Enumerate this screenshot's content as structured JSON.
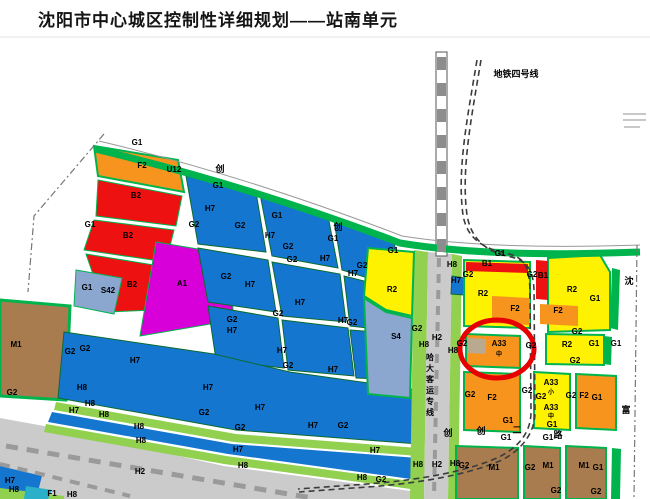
{
  "title": "沈阳市中心城区控制性详细规划——站南单元",
  "map": {
    "colors": {
      "blue": "#1576d0",
      "green": "#00b44d",
      "lgreen": "#92d050",
      "orange": "#f7941e",
      "red": "#ee1111",
      "yellow": "#fff200",
      "magenta": "#d800d8",
      "slate": "#8ba6cf",
      "brown": "#a87c4f",
      "gray": "#cbcbcb",
      "track": "#9a9a9a",
      "tan": "#b9a98e",
      "cyan": "#2ab0c8",
      "circle_red": "#e60000"
    },
    "annotations": {
      "metro_line_label": "地铁四号线",
      "railway_label_vertical": "哈大客运专线",
      "highlight_circle_target": "A33",
      "right_road_chars": "沈 富",
      "bottom_road_chars": "创 创 二 路"
    },
    "shapes": [
      {
        "n": "yard-h2",
        "f": "gray",
        "p": "0,418 44,426 224,466 418,492 418,499 0,499"
      },
      {
        "n": "parcel-f2-u12",
        "f": "orange",
        "st": "green",
        "sw": 2,
        "p": "94,146 178,160 184,192 98,176"
      },
      {
        "n": "parcel-b2-1",
        "f": "red",
        "st": "green",
        "sw": 1,
        "p": "98,180 182,196 176,226 96,216"
      },
      {
        "n": "parcel-b2-2",
        "f": "red",
        "st": "green",
        "sw": 1,
        "p": "94,220 174,230 166,262 84,250"
      },
      {
        "n": "parcel-b2-3",
        "f": "red",
        "st": "green",
        "sw": 1,
        "p": "86,254 160,266 154,310 106,312"
      },
      {
        "n": "parcel-s42",
        "f": "slate",
        "st": "green",
        "sw": 1,
        "p": "76,270 122,278 114,314 74,306"
      },
      {
        "n": "parcel-a1",
        "f": "magenta",
        "st": "green",
        "sw": 1,
        "p": "156,242 228,254 234,320 140,336"
      },
      {
        "n": "parcel-m1-west",
        "f": "brown",
        "st": "green",
        "sw": 3,
        "p": "0,300 70,306 66,400 0,396"
      },
      {
        "n": "parcel-h7",
        "f": "blue",
        "st": "#0a6b30",
        "sw": 1,
        "p": "186,176 256,192 266,252 198,244"
      },
      {
        "n": "parcel-h7",
        "f": "blue",
        "st": "#0a6b30",
        "sw": 1,
        "p": "260,194 328,216 338,268 272,256"
      },
      {
        "n": "parcel-h7",
        "f": "blue",
        "st": "#0a6b30",
        "sw": 1,
        "p": "334,220 394,240 400,288 342,270"
      },
      {
        "n": "parcel-h7",
        "f": "blue",
        "st": "#0a6b30",
        "sw": 1,
        "p": "198,248 268,260 276,312 208,302"
      },
      {
        "n": "parcel-h7",
        "f": "blue",
        "st": "#0a6b30",
        "sw": 1,
        "p": "272,262 340,274 346,322 282,316"
      },
      {
        "n": "parcel-h7",
        "f": "blue",
        "st": "#0a6b30",
        "sw": 1,
        "p": "344,276 400,290 404,332 350,326"
      },
      {
        "n": "parcel-h7",
        "f": "blue",
        "st": "#0a6b30",
        "sw": 1,
        "p": "208,306 278,318 284,368 216,360"
      },
      {
        "n": "parcel-h7",
        "f": "blue",
        "st": "#0a6b30",
        "sw": 1,
        "p": "282,320 348,328 354,376 288,370"
      },
      {
        "n": "parcel-h7",
        "f": "blue",
        "st": "#0a6b30",
        "sw": 1,
        "p": "350,330 404,334 408,380 356,378"
      },
      {
        "n": "parcel-h7-lower",
        "f": "blue",
        "st": "#0a6b30",
        "sw": 1,
        "p": "64,332 214,354 290,372 418,390 418,444 236,430 58,398"
      },
      {
        "n": "strip-h8",
        "f": "lgreen",
        "p": "56,402 236,434 418,448 418,456 234,442 54,410"
      },
      {
        "n": "strip-h7",
        "f": "blue",
        "p": "52,412 232,444 418,458 418,480 228,454 48,422"
      },
      {
        "n": "strip-h8",
        "f": "lgreen",
        "p": "46,424 226,456 418,482 418,490 224,464 44,432"
      },
      {
        "n": "corner-h7",
        "f": "blue",
        "p": "0,466 42,476 36,499 0,499"
      },
      {
        "n": "corner-h8",
        "f": "lgreen",
        "p": "0,488 64,496 64,499 0,499"
      },
      {
        "n": "corner-s",
        "f": "cyan",
        "p": "26,486 52,490 48,499 24,499"
      },
      {
        "n": "rail-strip-west",
        "f": "lgreen",
        "p": "414,250 428,252 424,499 410,499"
      },
      {
        "n": "rail-corridor-h2",
        "f": "gray",
        "p": "428,252 452,254 448,499 424,499"
      },
      {
        "n": "rail-strip-east",
        "f": "lgreen",
        "p": "452,254 462,256 458,499 448,499"
      },
      {
        "n": "parcel-h7-east-small",
        "f": "blue",
        "st": "#0a6b30",
        "sw": 1,
        "p": "452,276 465,278 464,295 451,294"
      },
      {
        "n": "parcel-r2-west",
        "f": "yellow",
        "st": "green",
        "sw": 2,
        "p": "368,248 414,252 412,316 386,310 364,296"
      },
      {
        "n": "parcel-s4",
        "f": "slate",
        "st": "green",
        "sw": 2,
        "p": "364,298 386,312 412,318 410,398 368,394"
      },
      {
        "n": "parcel-r2-a",
        "f": "yellow",
        "st": "green",
        "sw": 2,
        "p": "464,260 530,262 530,328 464,326"
      },
      {
        "n": "parcel-b1-strip",
        "f": "red",
        "p": "466,262 528,264 528,273 466,271"
      },
      {
        "n": "parcel-f2-inset",
        "f": "orange",
        "p": "492,296 530,298 530,325 492,323"
      },
      {
        "n": "parcel-r2-b",
        "f": "yellow",
        "st": "green",
        "sw": 2,
        "p": "548,258 600,255 610,272 610,330 548,332"
      },
      {
        "n": "parcel-b1-vert",
        "f": "red",
        "p": "536,260 548,261 548,300 536,299"
      },
      {
        "n": "parcel-f2-inset",
        "f": "orange",
        "p": "540,304 578,306 578,326 540,324"
      },
      {
        "n": "strip-g1-right",
        "f": "green",
        "p": "612,268 620,270 618,330 610,328"
      },
      {
        "n": "parcel-a33-circled",
        "f": "orange",
        "st": "green",
        "sw": 2,
        "p": "466,334 520,336 520,368 466,366"
      },
      {
        "n": "a33-inner-square",
        "f": "tan",
        "p": "468,338 486,339 486,354 468,353"
      },
      {
        "n": "parcel-r2-c",
        "f": "yellow",
        "st": "green",
        "sw": 2,
        "p": "546,334 604,335 604,365 546,364"
      },
      {
        "n": "strip-g1-right",
        "f": "green",
        "p": "604,336 612,337 611,365 603,364"
      },
      {
        "n": "parcel-f2-big",
        "f": "orange",
        "st": "green",
        "sw": 2,
        "p": "464,372 520,374 520,432 464,430"
      },
      {
        "n": "parcel-a33-block",
        "f": "yellow",
        "st": "green",
        "sw": 2,
        "p": "534,372 570,374 570,430 534,428"
      },
      {
        "n": "parcel-f2-east",
        "f": "orange",
        "st": "green",
        "sw": 2,
        "p": "576,374 616,376 616,430 576,428"
      },
      {
        "n": "parcel-m1-a",
        "f": "brown",
        "st": "green",
        "sw": 2,
        "p": "456,446 518,448 518,499 456,499"
      },
      {
        "n": "parcel-m1-b",
        "f": "brown",
        "st": "green",
        "sw": 2,
        "p": "524,446 560,448 560,499 524,499"
      },
      {
        "n": "parcel-m1-c",
        "f": "brown",
        "st": "green",
        "sw": 2,
        "p": "566,446 606,448 606,499 566,499"
      },
      {
        "n": "strip-g1-right",
        "f": "green",
        "p": "612,448 621,449 620,499 611,499"
      },
      {
        "n": "railway-bar",
        "f": "#ffffff",
        "st": "#555555",
        "sw": 1,
        "p": "436,52 447,52 447,256 436,256"
      }
    ],
    "lines": [
      {
        "n": "title-underline",
        "s": "#e5e5e5",
        "w": 1,
        "d": "M0,37 L650,37"
      },
      {
        "n": "boundary-arc-road",
        "s": "#999999",
        "w": 1,
        "d": "M99,141 Q250,177 402,236 Q490,250 640,245"
      },
      {
        "n": "greenbelt-arc",
        "s": "green",
        "w": 7,
        "d": "M95,149 Q250,186 400,243 Q490,258 640,252"
      },
      {
        "n": "boundary-left-dashed",
        "s": "#777777",
        "w": 1.2,
        "da": "7,3,2,3",
        "d": "M104,134 L34,216 L28,292"
      },
      {
        "n": "boundary-right-dashed",
        "s": "#777777",
        "w": 1.2,
        "da": "7,3,2,3",
        "d": "M637,245 L634,499"
      },
      {
        "n": "railway-bar-stripes",
        "s": "#8d8d8d",
        "w": 9,
        "da": "13,13",
        "d": "M441.5,57 L441.5,253"
      },
      {
        "n": "rail-track-corridor",
        "s": "track",
        "w": 4,
        "da": "9,7",
        "d": "M439,258 L434,497"
      },
      {
        "n": "rail-track-yard",
        "s": "track",
        "w": 5,
        "da": "12,9",
        "d": "M6,446 L312,498"
      },
      {
        "n": "rail-track-yard2",
        "s": "track",
        "w": 4,
        "da": "10,8",
        "d": "M0,464 L130,496"
      },
      {
        "n": "metro-line-4",
        "s": "#3c3c3c",
        "w": 1.6,
        "da": "6,4",
        "d": "M477,60 C467,120 457,170 463,215 C467,240 486,249 505,253 C526,257 529,268 530,290 L531,412 C531,432 519,447 499,457 C468,471 420,481 352,485 L298,489"
      },
      {
        "n": "metro-line-4",
        "s": "#3c3c3c",
        "w": 1.6,
        "da": "6,4",
        "d": "M481,60 C471,120 461,170 467,215 C471,240 488,252 507,256 C528,260 533,270 534,290 L535,412 C535,432 523,449 502,460 C470,474 421,484 353,488 L299,492"
      },
      {
        "n": "faint-stamp-line",
        "s": "#c8c8c8",
        "w": 2,
        "d": "M623,114 L646,114"
      },
      {
        "n": "faint-stamp-line",
        "s": "#c8c8c8",
        "w": 2,
        "d": "M623,120 L646,120"
      },
      {
        "n": "faint-stamp-line",
        "s": "#c8c8c8",
        "w": 2,
        "d": "M624,127 L640,127"
      },
      {
        "n": "highlight-circle",
        "s": "circle_red",
        "w": 5,
        "d": "M460,349 a37,29 0 1 0 74,0 a37,29 0 1 0 -74,0"
      }
    ],
    "labels": [
      {
        "t": "G1",
        "x": 137,
        "y": 145
      },
      {
        "t": "G1",
        "x": 218,
        "y": 188
      },
      {
        "t": "G1",
        "x": 277,
        "y": 218
      },
      {
        "t": "G1",
        "x": 333,
        "y": 241
      },
      {
        "t": "G1",
        "x": 393,
        "y": 253
      },
      {
        "t": "G1",
        "x": 500,
        "y": 256
      },
      {
        "t": "创",
        "x": 220,
        "y": 172,
        "s": 9
      },
      {
        "t": "创",
        "x": 338,
        "y": 230,
        "s": 9
      },
      {
        "t": "地铁四号线",
        "x": 516,
        "y": 77,
        "s": 9
      },
      {
        "t": "F2",
        "x": 142,
        "y": 168
      },
      {
        "t": "U12",
        "x": 174,
        "y": 172
      },
      {
        "t": "B2",
        "x": 136,
        "y": 198
      },
      {
        "t": "B2",
        "x": 128,
        "y": 238
      },
      {
        "t": "B2",
        "x": 132,
        "y": 287
      },
      {
        "t": "G1",
        "x": 90,
        "y": 227
      },
      {
        "t": "G1",
        "x": 87,
        "y": 290
      },
      {
        "t": "S42",
        "x": 108,
        "y": 293
      },
      {
        "t": "A1",
        "x": 182,
        "y": 286
      },
      {
        "t": "M1",
        "x": 16,
        "y": 347
      },
      {
        "t": "G2",
        "x": 70,
        "y": 354
      },
      {
        "t": "G2",
        "x": 85,
        "y": 351
      },
      {
        "t": "G2",
        "x": 12,
        "y": 395
      },
      {
        "t": "H7",
        "x": 210,
        "y": 211
      },
      {
        "t": "H7",
        "x": 270,
        "y": 238
      },
      {
        "t": "H7",
        "x": 325,
        "y": 261
      },
      {
        "t": "H7",
        "x": 353,
        "y": 276
      },
      {
        "t": "H7",
        "x": 250,
        "y": 287
      },
      {
        "t": "H7",
        "x": 300,
        "y": 305
      },
      {
        "t": "H7",
        "x": 343,
        "y": 323
      },
      {
        "t": "H7",
        "x": 232,
        "y": 333
      },
      {
        "t": "H7",
        "x": 282,
        "y": 353
      },
      {
        "t": "H7",
        "x": 333,
        "y": 372
      },
      {
        "t": "H7",
        "x": 135,
        "y": 363
      },
      {
        "t": "H7",
        "x": 208,
        "y": 390
      },
      {
        "t": "H7",
        "x": 260,
        "y": 410
      },
      {
        "t": "H7",
        "x": 313,
        "y": 428
      },
      {
        "t": "H7",
        "x": 238,
        "y": 452
      },
      {
        "t": "H7",
        "x": 375,
        "y": 453
      },
      {
        "t": "H7",
        "x": 74,
        "y": 413
      },
      {
        "t": "H7",
        "x": 10,
        "y": 483
      },
      {
        "t": "H7",
        "x": 456,
        "y": 283
      },
      {
        "t": "G2",
        "x": 194,
        "y": 227
      },
      {
        "t": "G2",
        "x": 240,
        "y": 228
      },
      {
        "t": "G2",
        "x": 288,
        "y": 249
      },
      {
        "t": "G2",
        "x": 292,
        "y": 262
      },
      {
        "t": "G2",
        "x": 226,
        "y": 279
      },
      {
        "t": "G2",
        "x": 232,
        "y": 322
      },
      {
        "t": "G2",
        "x": 278,
        "y": 316
      },
      {
        "t": "G2",
        "x": 352,
        "y": 325
      },
      {
        "t": "G2",
        "x": 288,
        "y": 368
      },
      {
        "t": "G2",
        "x": 240,
        "y": 430
      },
      {
        "t": "G2",
        "x": 343,
        "y": 428
      },
      {
        "t": "G2",
        "x": 204,
        "y": 415
      },
      {
        "t": "R2",
        "x": 392,
        "y": 292
      },
      {
        "t": "S4",
        "x": 396,
        "y": 339
      },
      {
        "t": "G2",
        "x": 362,
        "y": 268
      },
      {
        "t": "G2",
        "x": 417,
        "y": 331
      },
      {
        "t": "H8",
        "x": 452,
        "y": 267
      },
      {
        "t": "H8",
        "x": 424,
        "y": 347
      },
      {
        "t": "H2",
        "x": 437,
        "y": 340
      },
      {
        "t": "H8",
        "x": 453,
        "y": 353
      },
      {
        "t": "H8",
        "x": 418,
        "y": 467
      },
      {
        "t": "H2",
        "x": 437,
        "y": 467
      },
      {
        "t": "H8",
        "x": 455,
        "y": 466
      },
      {
        "t": "哈",
        "x": 430,
        "y": 360,
        "s": 8
      },
      {
        "t": "大",
        "x": 430,
        "y": 371,
        "s": 8
      },
      {
        "t": "客",
        "x": 430,
        "y": 382,
        "s": 8
      },
      {
        "t": "运",
        "x": 430,
        "y": 393,
        "s": 8
      },
      {
        "t": "专",
        "x": 430,
        "y": 404,
        "s": 8
      },
      {
        "t": "线",
        "x": 430,
        "y": 415,
        "s": 8
      },
      {
        "t": "B1",
        "x": 487,
        "y": 266
      },
      {
        "t": "B1",
        "x": 543,
        "y": 278
      },
      {
        "t": "G2",
        "x": 468,
        "y": 277
      },
      {
        "t": "G2",
        "x": 532,
        "y": 277
      },
      {
        "t": "R2",
        "x": 483,
        "y": 296
      },
      {
        "t": "F2",
        "x": 515,
        "y": 311
      },
      {
        "t": "R2",
        "x": 572,
        "y": 292
      },
      {
        "t": "F2",
        "x": 558,
        "y": 313
      },
      {
        "t": "G1",
        "x": 595,
        "y": 301
      },
      {
        "t": "沈",
        "x": 629,
        "y": 284,
        "s": 9
      },
      {
        "t": "G2",
        "x": 577,
        "y": 334
      },
      {
        "t": "A33",
        "x": 499,
        "y": 346
      },
      {
        "t": "中",
        "x": 499,
        "y": 356,
        "s": 6
      },
      {
        "t": "G2",
        "x": 462,
        "y": 346
      },
      {
        "t": "G2",
        "x": 531,
        "y": 348
      },
      {
        "t": "R2",
        "x": 567,
        "y": 347
      },
      {
        "t": "G1",
        "x": 594,
        "y": 346
      },
      {
        "t": "G1",
        "x": 616,
        "y": 346
      },
      {
        "t": "G2",
        "x": 575,
        "y": 363
      },
      {
        "t": "F2",
        "x": 492,
        "y": 400
      },
      {
        "t": "G2",
        "x": 470,
        "y": 397
      },
      {
        "t": "G1",
        "x": 508,
        "y": 423
      },
      {
        "t": "G2",
        "x": 527,
        "y": 393
      },
      {
        "t": "G2",
        "x": 541,
        "y": 399
      },
      {
        "t": "A33",
        "x": 551,
        "y": 385
      },
      {
        "t": "小",
        "x": 551,
        "y": 394,
        "s": 6
      },
      {
        "t": "A33",
        "x": 551,
        "y": 410
      },
      {
        "t": "中",
        "x": 551,
        "y": 418,
        "s": 6
      },
      {
        "t": "G1",
        "x": 552,
        "y": 427
      },
      {
        "t": "G2",
        "x": 571,
        "y": 398
      },
      {
        "t": "F2",
        "x": 584,
        "y": 398
      },
      {
        "t": "G1",
        "x": 597,
        "y": 400
      },
      {
        "t": "创",
        "x": 448,
        "y": 436,
        "s": 9
      },
      {
        "t": "创",
        "x": 481,
        "y": 434,
        "s": 9
      },
      {
        "t": "二",
        "x": 517,
        "y": 433,
        "s": 9
      },
      {
        "t": "路",
        "x": 558,
        "y": 438,
        "s": 9
      },
      {
        "t": "G1",
        "x": 506,
        "y": 440
      },
      {
        "t": "G1",
        "x": 548,
        "y": 440
      },
      {
        "t": "富",
        "x": 626,
        "y": 413,
        "s": 9
      },
      {
        "t": "M1",
        "x": 494,
        "y": 470
      },
      {
        "t": "G2",
        "x": 530,
        "y": 470
      },
      {
        "t": "M1",
        "x": 548,
        "y": 468
      },
      {
        "t": "M1",
        "x": 584,
        "y": 468
      },
      {
        "t": "G1",
        "x": 598,
        "y": 470
      },
      {
        "t": "G2",
        "x": 556,
        "y": 493
      },
      {
        "t": "G2",
        "x": 596,
        "y": 494
      },
      {
        "t": "G2",
        "x": 464,
        "y": 468
      },
      {
        "t": "H8",
        "x": 82,
        "y": 390
      },
      {
        "t": "H8",
        "x": 90,
        "y": 406
      },
      {
        "t": "H8",
        "x": 104,
        "y": 417
      },
      {
        "t": "H8",
        "x": 139,
        "y": 429
      },
      {
        "t": "H8",
        "x": 141,
        "y": 443
      },
      {
        "t": "H2",
        "x": 140,
        "y": 474
      },
      {
        "t": "H8",
        "x": 243,
        "y": 468
      },
      {
        "t": "H8",
        "x": 362,
        "y": 480
      },
      {
        "t": "G2",
        "x": 381,
        "y": 482
      },
      {
        "t": "H8",
        "x": 14,
        "y": 492
      },
      {
        "t": "F1",
        "x": 52,
        "y": 496
      },
      {
        "t": "H8",
        "x": 72,
        "y": 497
      }
    ]
  }
}
